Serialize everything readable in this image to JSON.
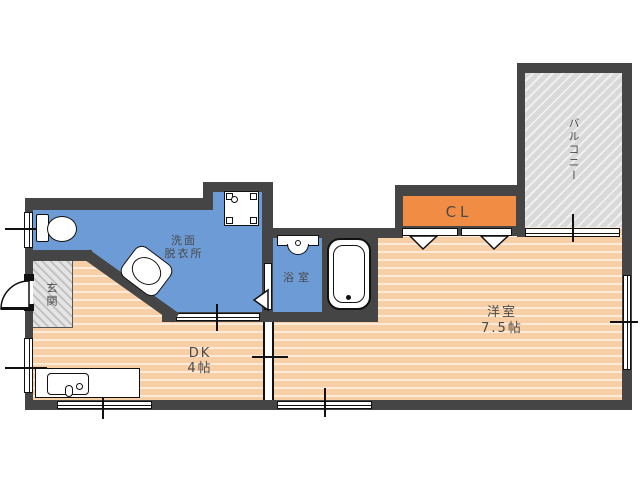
{
  "rooms": {
    "washroom": {
      "line1": "洗面",
      "line2": "脱衣所"
    },
    "bathroom": {
      "label": "浴室"
    },
    "entrance": {
      "label": "玄関"
    },
    "dining_kitchen": {
      "line1": "DK",
      "line2": "4帖"
    },
    "western_room": {
      "line1": "洋室",
      "line2": "7.5帖"
    },
    "closet": {
      "label": "CL"
    },
    "balcony": {
      "label": "バルコニー"
    }
  },
  "colors": {
    "wall": "#454545",
    "wet-room": "#6d9bd6",
    "floor": "#f7cfa6",
    "floor-stripe": "#fcead8",
    "closet": "#f08c44",
    "balcony": "#d9d9d9",
    "balcony-stripe": "#f0f0f0",
    "entrance-hatch": "#bfbfbf",
    "entrance-hatch-bg": "#e4e4e4",
    "text": "#4a4a4a",
    "line": "#111111"
  }
}
